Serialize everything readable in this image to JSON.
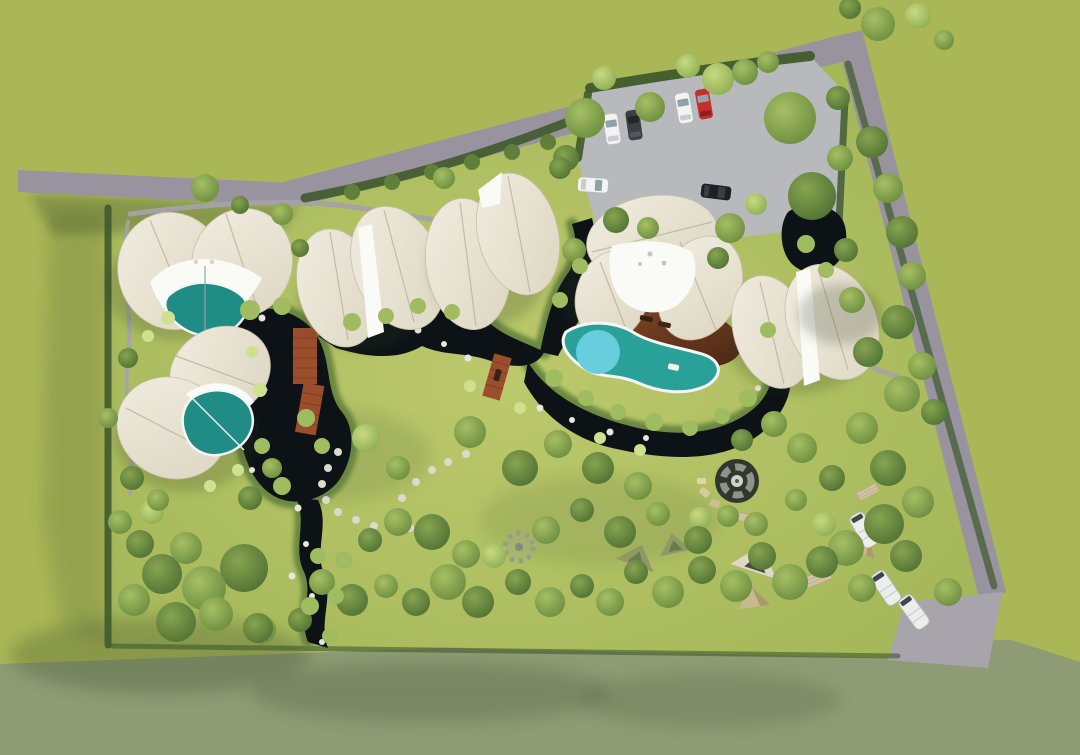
{
  "meta": {
    "type": "aerial 3D architectural rendering",
    "subject": "glamping resort site plan, top-down bird's-eye view",
    "visible_text": []
  },
  "colors": {
    "grass_outside": "#a9b757",
    "grass_outside_dark": "#8e9b74",
    "lawn_hi": "#bcc96c",
    "lawn": "#9fb355",
    "shadow": "#2e3d20",
    "tree_light_hi": "#c9da80",
    "tree_light": "#8fae54",
    "tree_mid_hi": "#a6bf64",
    "tree_mid": "#6d8f40",
    "tree_dark_hi": "#87a451",
    "tree_dark": "#527434",
    "shrub": "#5f7f3a",
    "shrub_light": "#9fbd60",
    "shrub_pale": "#cfe08f",
    "hedge": "#3f5a2c",
    "water": "#0c1216",
    "pool_teal": "#2aa198",
    "pool_teal_deep": "#1f8d85",
    "pool_light": "#67ccdc",
    "pool_rim": "#f4f7f5",
    "roof_hi": "#f1ede0",
    "roof": "#dcd5c1",
    "roof_line": "#b8b09a",
    "canopy": "#fafaf6",
    "deck_hi": "#8a4d28",
    "deck": "#4e2715",
    "road": "#98939e",
    "road_light": "#a8a4ac",
    "parking": "#b7b9bc",
    "path": "#a5a1a9",
    "stone": "#dcd9cd",
    "bridge": "#9a4e2b",
    "bridge_dark": "#7a3a1e",
    "car_white": "#f2f3f2",
    "car_dark": "#3c4043",
    "car_red": "#c32f2a",
    "car_black": "#1e2124",
    "car_glass": "#8fa0a8",
    "caravan": "#eceeec",
    "camp_tan": "#c7b88e",
    "camp_camo": "#8e9a66",
    "firepit": "#31372f",
    "firepit_ring": "#8d948a",
    "firepit_center": "#d3d2ca",
    "mat": "#cfc3a4"
  },
  "scene": {
    "tent_villas": {
      "count": 6,
      "with_plunge_pool": 3,
      "roof_style": "white petal canopies"
    },
    "main_lodge": {
      "count": 1,
      "deck": "hardwood",
      "pool": "free-form with round shallow end",
      "loungers": 2
    },
    "parking": {
      "surface": "gravel",
      "car_count": 6,
      "car_colors": [
        "white",
        "dark-gray",
        "white",
        "red",
        "white",
        "black"
      ]
    },
    "campground": {
      "caravans": 3,
      "tents": 5,
      "fire_pit": 1,
      "picnic_mats": 3,
      "stone_circle": 1
    },
    "water": {
      "features": "dark reflective pond and winding stream",
      "bridges": 2,
      "boardwalk": 1
    },
    "circulation": {
      "boundary_roads": 3,
      "entrance": "south-east corner",
      "stepping_stone_loop": 1
    },
    "vegetation": {
      "perimeter": "dense tree buffer",
      "interior": "open yellow-green lawn with scattered trees"
    }
  }
}
